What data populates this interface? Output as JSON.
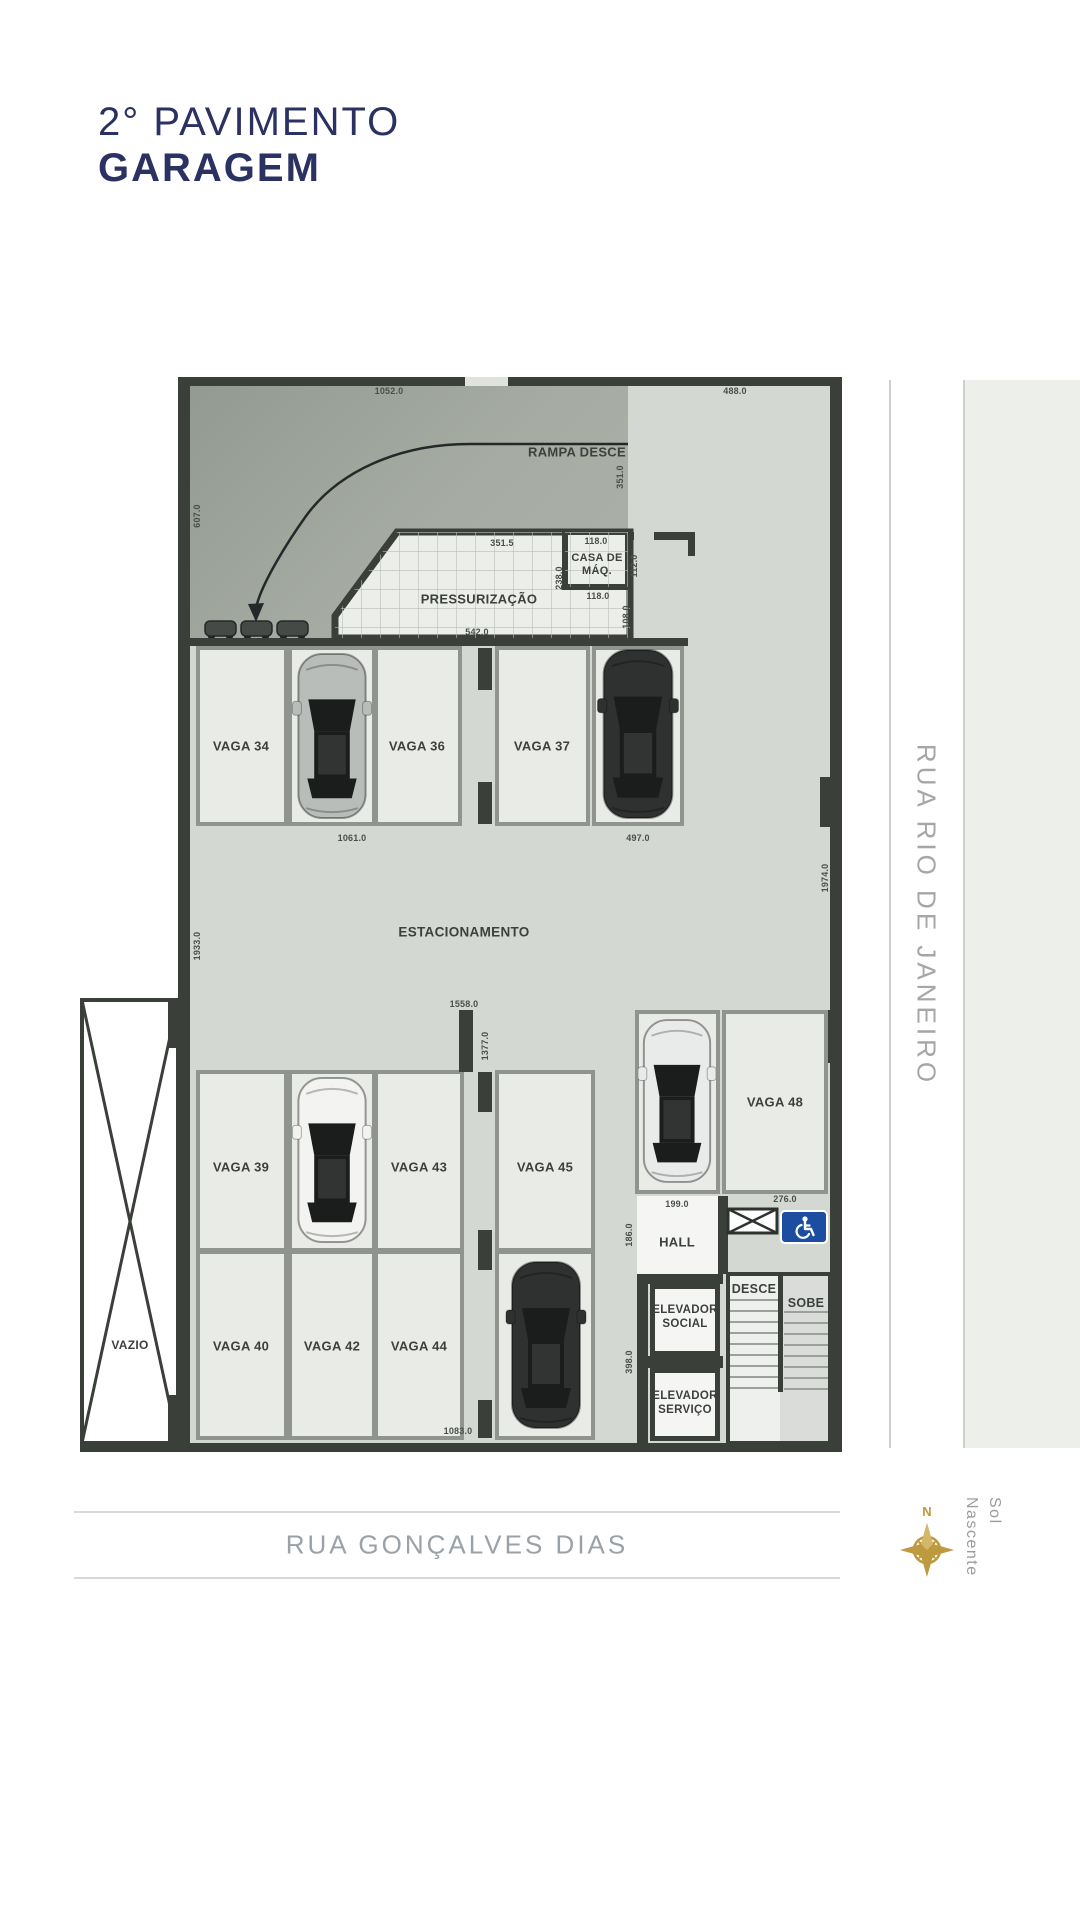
{
  "title": {
    "line1": "2° PAVIMENTO",
    "line2": "GARAGEM"
  },
  "streets": {
    "right": "RUA RIO DE JANEIRO",
    "bottom": "RUA GONÇALVES DIAS"
  },
  "compass": {
    "north": "N",
    "label": "Sol Nascente"
  },
  "plan": {
    "ramp_label": "RAMPA DESCE",
    "pressurizacao": "PRESSURIZAÇÃO",
    "casa_maq": "CASA DE MÁQ.",
    "estacionamento": "ESTACIONAMENTO",
    "hall": "HALL",
    "desce": "DESCE",
    "sobe": "SOBE",
    "elevador_social": "ELEVADOR SOCIAL",
    "elevador_servico": "ELEVADOR SERVIÇO",
    "vazio": "VAZIO",
    "vagas": {
      "v34": "VAGA 34",
      "v36": "VAGA 36",
      "v37": "VAGA 37",
      "v39": "VAGA 39",
      "v40": "VAGA 40",
      "v42": "VAGA 42",
      "v43": "VAGA 43",
      "v44": "VAGA 44",
      "v45": "VAGA 45",
      "v48": "VAGA 48"
    },
    "dims": {
      "top_ramp": "1052.0",
      "top_right": "488.0",
      "left_ramp": "607.0",
      "ramp_right": "351.0",
      "press_top": "351.5",
      "casa_top": "118.0",
      "casa_right": "112.0",
      "casa_bottom": "118.0",
      "press_right": "238.0",
      "press_bottom": "542.0",
      "below_casa": "108.0",
      "row1_main": "1061.0",
      "row1_right": "497.0",
      "left_wall": "1933.0",
      "right_wall": "1974.0",
      "mid_top": "1558.0",
      "mid_wall": "1377.0",
      "vaga48_w": "276.0",
      "hall_w": "199.0",
      "hall_h": "186.0",
      "elev_h": "398.0",
      "row3_main": "1083.0"
    }
  },
  "colors": {
    "accent_navy": "#2b3161",
    "compass_gold": "#bd9a3f",
    "handicap_blue": "#1c4da0"
  }
}
